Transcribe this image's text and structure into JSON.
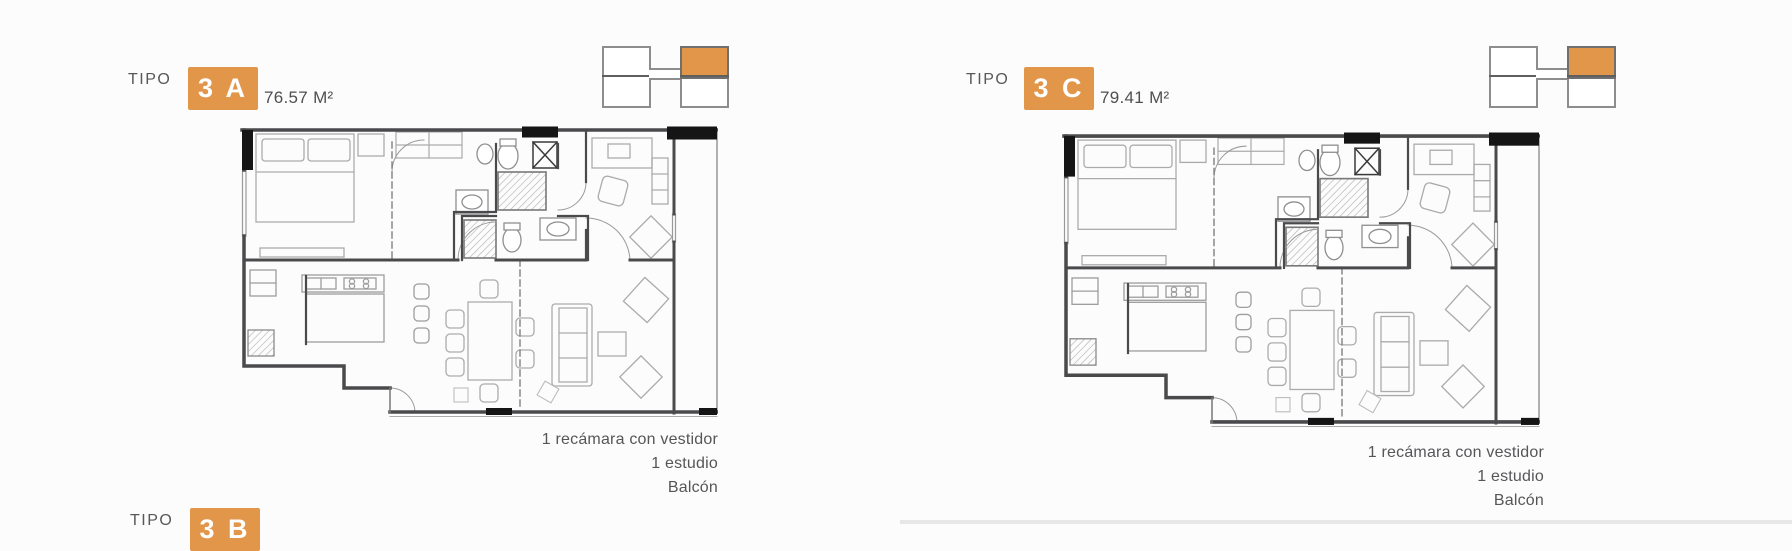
{
  "theme": {
    "accent": "#E2964A",
    "wall": "#4a4a4c",
    "text_gray": "#57575a"
  },
  "units": [
    {
      "tipo_label": "TIPO",
      "code": "3 A",
      "area": "76.57 M²",
      "features": [
        "1 recámara con vestidor",
        "1 estudio",
        "Balcón"
      ],
      "key_icon": "tower-position-key-top-right-highlighted"
    },
    {
      "tipo_label": "TIPO",
      "code": "3 C",
      "area": "79.41 M²",
      "features": [
        "1 recámara con vestidor",
        "1 estudio",
        "Balcón"
      ],
      "key_icon": "tower-position-key-top-right-highlighted"
    },
    {
      "tipo_label": "TIPO",
      "code": "3 B",
      "area": "",
      "features": []
    }
  ]
}
